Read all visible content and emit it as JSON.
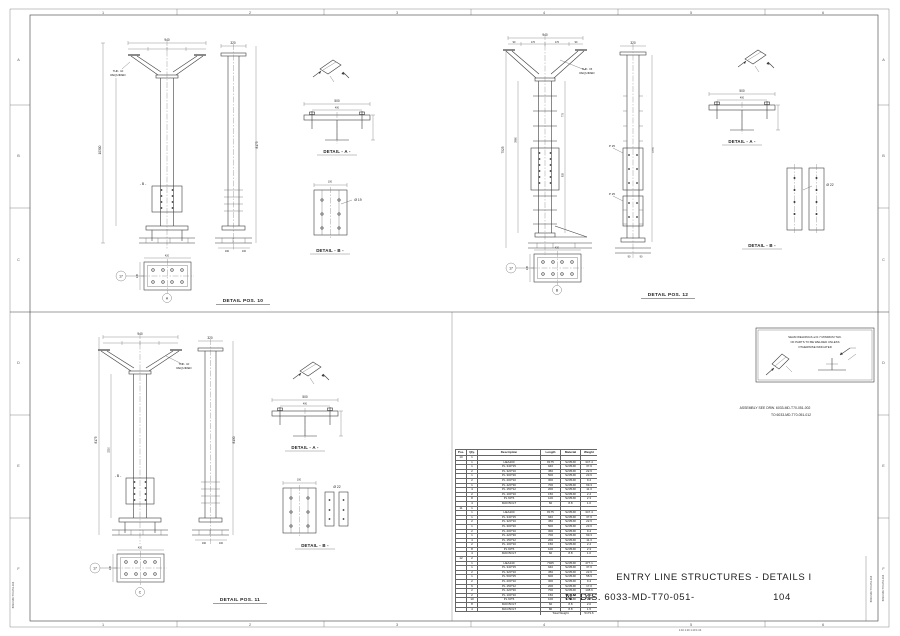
{
  "sheet": {
    "grid_top": [
      "1",
      "2",
      "3",
      "4",
      "5",
      "6"
    ],
    "grid_bottom": [
      "1",
      "2",
      "3",
      "4",
      "5",
      "6"
    ],
    "grid_left": [
      "A",
      "B",
      "C",
      "D",
      "E",
      "F"
    ],
    "grid_right": [
      "A",
      "B",
      "C",
      "D",
      "E",
      "F"
    ],
    "footer_scales": "1:10      1:10      1:10      1:10",
    "side_doc_no": "6033-MD-T70-051-104"
  },
  "title_block": {
    "line1": "ENTRY LINE STRUCTURES - DETAILS I",
    "line2": "N° DIS. 6033-MD-T70-051-",
    "sheet_no": "104"
  },
  "notes": {
    "weld_line1": "SEAM WELDINGS a=0.7 MINIMUM THK.",
    "weld_line2": "OF PARTS TO BE WELDED UNLESS",
    "weld_line3": "OTHERWISE INDICATED",
    "assembly_line1": "ASSEMBLY SEE DRW. 6033-MD-T70-051-002",
    "assembly_line2": "TO 6033-MD-T70-051-012"
  },
  "quadrants": {
    "q10": {
      "caption": "DETAIL POS. 10",
      "detail_a": "DETAIL - A -",
      "detail_b": "DETAIL - B -",
      "note1": "THK. 10",
      "note2": "REQUIRED",
      "section_mark": "- B -",
      "balloon_left": "17",
      "balloon_bottom": "A",
      "dim_top": "940",
      "dim_side_top": "320",
      "dim_height": "10300",
      "dim_height_side": "8175",
      "dim_a1": "500",
      "dim_a2": "400",
      "dim_b1": "100",
      "hole_b": "Ø 19",
      "dim_plan_w": "420",
      "dim_plan_h": "145",
      "dim_base1": "190",
      "dim_base2": "100"
    },
    "q12": {
      "caption": "DETAIL POS. 12",
      "detail_a": "DETAIL - A -",
      "detail_b": "DETAIL - B -",
      "note1": "THK. 15",
      "note2": "REQUIRED",
      "p_label": "P 25",
      "subdims": [
        "90",
        "170",
        "170",
        "90"
      ],
      "balloon_left": "17",
      "balloon_bottom": "B",
      "dim_top": "940",
      "dim_side_top": "320",
      "dim_height": "7925",
      "dim_height2": "3960",
      "dim_seg1": "775",
      "dim_seg2": "935",
      "dim_side": "1770",
      "dim_a1": "500",
      "dim_a2": "400",
      "hole_b": "Ø 22",
      "dim_plan_w": "420",
      "dim_plan_h": "145",
      "dim_base1": "90",
      "dim_base2": "90"
    },
    "q11": {
      "caption": "DETAIL POS. 11",
      "detail_a": "DETAIL - A -",
      "detail_b": "DETAIL - B -",
      "note1": "THK. 10",
      "note2": "REQUIRED",
      "section_mark": "- B -",
      "balloon_left": "17",
      "balloon_bottom": "C",
      "dim_top": "940",
      "dim_side_top": "320",
      "dim_height": "8175",
      "dim_height2": "3210",
      "dim_height_side": "8130",
      "dim_a1": "500",
      "dim_a2": "400",
      "dim_b1": "100",
      "hole_b": "Ø 22",
      "dim_plan_w": "420",
      "dim_plan_h": "145",
      "dim_base1": "190",
      "dim_base2": "100"
    }
  },
  "table": {
    "headers": [
      "Pos.",
      "Qty.",
      "Description",
      "Length",
      "Material",
      "Weight"
    ],
    "rows": [
      [
        "10",
        "1",
        "",
        "",
        "",
        ""
      ],
      [
        "",
        "1",
        "HEA200",
        "8175",
        "S235JR",
        "347.4"
      ],
      [
        "",
        "1",
        "PL 340*15",
        "940",
        "S235JR",
        "37.6"
      ],
      [
        "",
        "2",
        "PL 320*10",
        "450",
        "S235JR",
        "22.6"
      ],
      [
        "",
        "1",
        "PL 300*20",
        "500",
        "S235JR",
        "23.6"
      ],
      [
        "",
        "2",
        "PL 200*10",
        "300",
        "S235JR",
        "9.4"
      ],
      [
        "",
        "1",
        "PL 420*30",
        "700",
        "S235JR",
        "69.3"
      ],
      [
        "",
        "4",
        "PL 150*12",
        "200",
        "S235JR",
        "11.3"
      ],
      [
        "",
        "2",
        "PL 100*10",
        "150",
        "S235JR",
        "2.4"
      ],
      [
        "",
        "8",
        "PL 60*6",
        "100",
        "S235JR",
        "2.3"
      ],
      [
        "",
        "4",
        "M20 BOLT",
        "60",
        "8.8",
        "1.0"
      ],
      [
        "11",
        "1",
        "",
        "",
        "",
        ""
      ],
      [
        "",
        "1",
        "HEA200",
        "8175",
        "S235JR",
        "347.4"
      ],
      [
        "",
        "1",
        "PL 340*15",
        "940",
        "S235JR",
        "37.6"
      ],
      [
        "",
        "2",
        "PL 320*10",
        "450",
        "S235JR",
        "22.6"
      ],
      [
        "",
        "1",
        "PL 300*20",
        "500",
        "S235JR",
        "23.6"
      ],
      [
        "",
        "2",
        "PL 200*10",
        "300",
        "S235JR",
        "9.4"
      ],
      [
        "",
        "1",
        "PL 420*30",
        "700",
        "S235JR",
        "69.3"
      ],
      [
        "",
        "4",
        "PL 150*12",
        "200",
        "S235JR",
        "11.3"
      ],
      [
        "",
        "2",
        "PL 100*10",
        "150",
        "S235JR",
        "2.4"
      ],
      [
        "",
        "8",
        "PL 60*6",
        "100",
        "S235JR",
        "2.3"
      ],
      [
        "",
        "4",
        "M20 BOLT",
        "60",
        "8.8",
        "1.0"
      ],
      [
        "12",
        "2",
        "",
        "",
        "",
        ""
      ],
      [
        "",
        "1",
        "HEA240",
        "7925",
        "S235JR",
        "477.1"
      ],
      [
        "",
        "1",
        "PL 340*15",
        "940",
        "S235JR",
        "37.6"
      ],
      [
        "",
        "2",
        "PL 320*10",
        "450",
        "S235JR",
        "22.6"
      ],
      [
        "",
        "1",
        "PL 500*25",
        "600",
        "S235JR",
        "58.9"
      ],
      [
        "",
        "2",
        "PL 200*10",
        "300",
        "S235JR",
        "9.4"
      ],
      [
        "",
        "6",
        "PL 150*12",
        "200",
        "S235JR",
        "17.0"
      ],
      [
        "",
        "2",
        "PL 420*30",
        "700",
        "S235JR",
        "138.6"
      ],
      [
        "",
        "2",
        "PL 100*10",
        "150",
        "S235JR",
        "2.4"
      ],
      [
        "",
        "10",
        "PL 60*6",
        "100",
        "S235JR",
        "2.8"
      ],
      [
        "",
        "8",
        "M20 BOLT",
        "60",
        "8.8",
        "2.0"
      ],
      [
        "",
        "4",
        "M24 BOLT",
        "80",
        "8.8",
        "1.5"
      ]
    ],
    "total_label": "Total Weight",
    "total_value": "5173.6"
  }
}
